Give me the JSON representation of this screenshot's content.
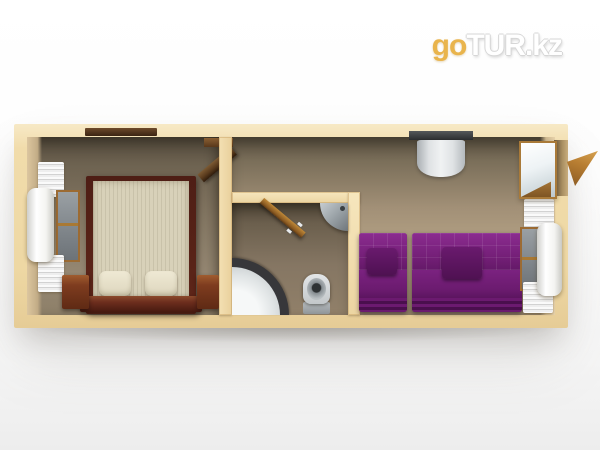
{
  "watermark": {
    "prefix": "go",
    "suffix": "TUR.kz",
    "prefix_color": "#e9b44c",
    "suffix_color": "#ffffff"
  },
  "scene": {
    "kind": "3D architectural render",
    "view": "top-down cutaway floor plan of a rectangular modular cabin",
    "rooms": [
      {
        "id": "bedroom",
        "position": "left",
        "objects": [
          "double bed with beige mattress and maroon wood frame",
          "two cream pillows",
          "dark wood nightstand left",
          "dark wood nightstand right",
          "window with white roller blind and pleated curtains",
          "dark wall shelf",
          "open interior door"
        ]
      },
      {
        "id": "bathroom",
        "position": "center-bottom",
        "objects": [
          "white corner shower tray with dark curved rail",
          "toilet",
          "corner wash basin",
          "open wooden door"
        ]
      },
      {
        "id": "hallway",
        "position": "center-top",
        "objects": []
      },
      {
        "id": "lounge",
        "position": "right",
        "objects": [
          "small purple sofa with cushion",
          "large purple sofa with cushion",
          "silver wall-mounted unit on dark bracket",
          "window with white roller blind and pleated curtains",
          "entrance door open outward with white panel"
        ]
      }
    ],
    "palette": {
      "background_top": "#ffffff",
      "background_bottom": "#ededed",
      "outer_walls": "#f1dcab",
      "bedroom_floor": "#8d7f68",
      "hall_lounge_floor": "#a8977c",
      "bathroom_floor": "#857663",
      "bed_frame": "#5a241b",
      "mattress": "#d8d1b9",
      "pillow": "#e9e3cd",
      "nightstand": "#7e3c1f",
      "sofa_purple": "#6e1d72",
      "shower_rail": "#37373a",
      "fixture_gray": "#c3c8ca",
      "wood_door": "#b5762f",
      "logo_gold": "#e9b44c"
    }
  }
}
